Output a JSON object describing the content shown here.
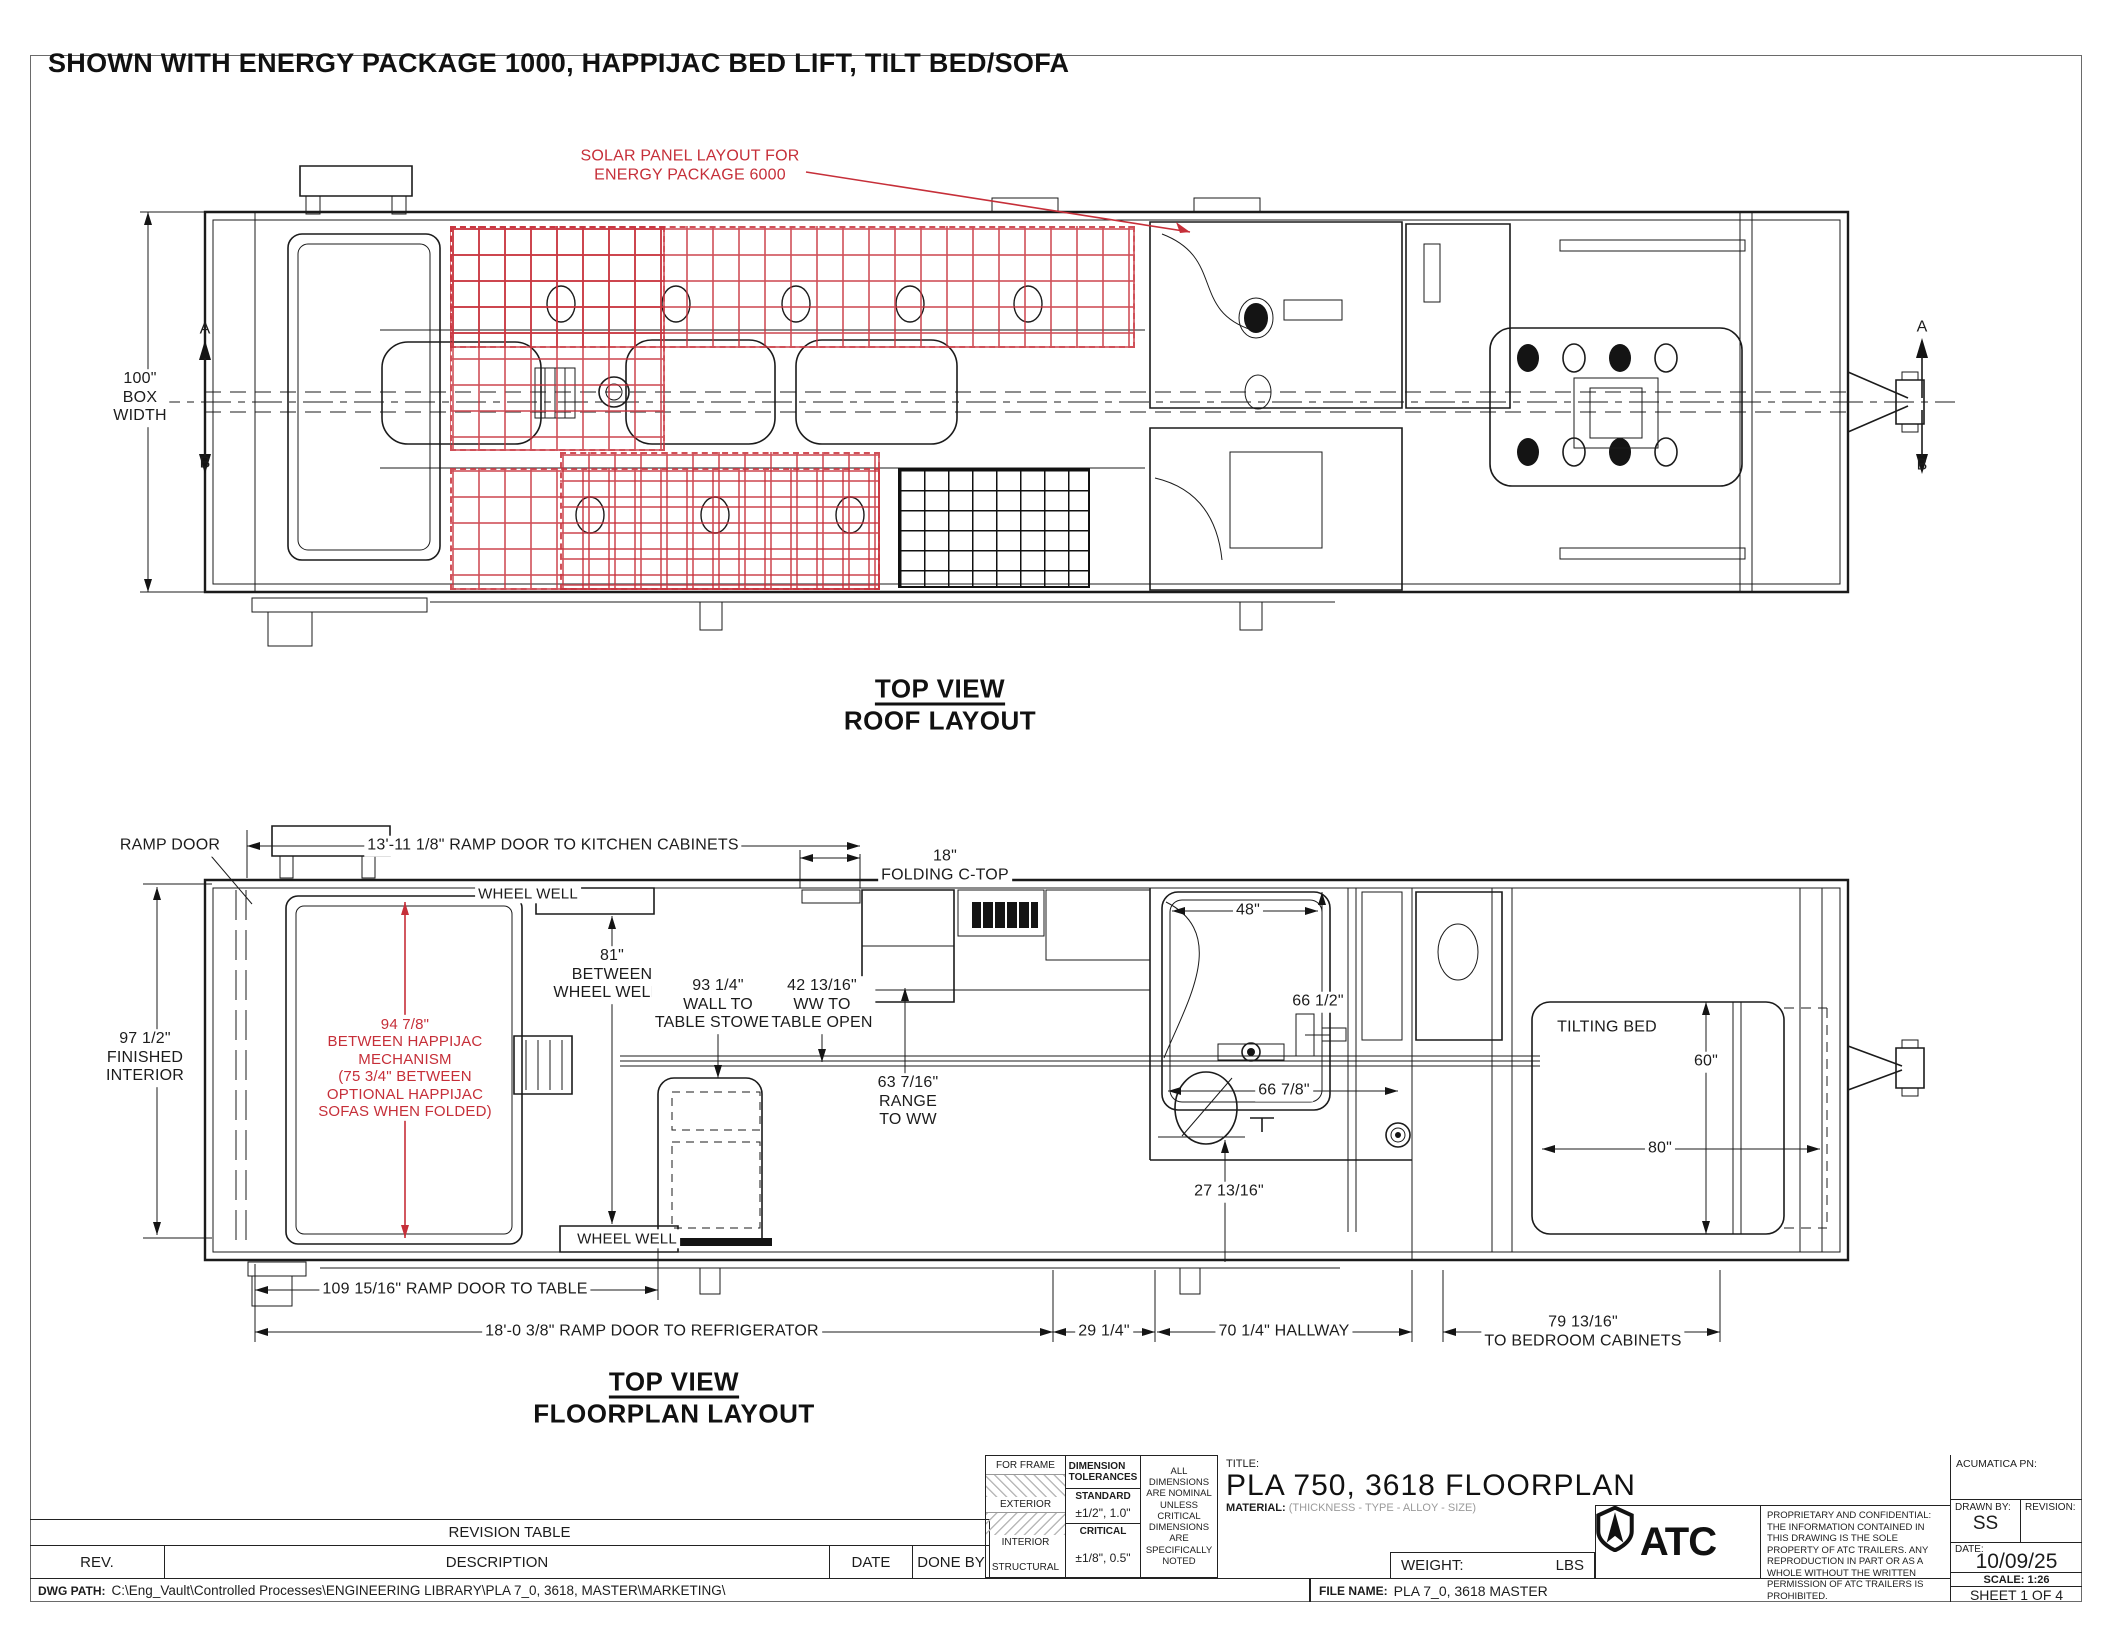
{
  "sheet": {
    "heading": "SHOWN WITH ENERGY PACKAGE 1000, HAPPIJAC BED LIFT, TILT BED/SOFA",
    "accent_red": "#c62f39"
  },
  "roof": {
    "solar_note": "SOLAR PANEL LAYOUT FOR\nENERGY PACKAGE 6000",
    "box_width": "100\"\nBOX\nWIDTH",
    "section_a": "A",
    "section_b": "B",
    "caption": "TOP VIEW",
    "caption_sub": "ROOF LAYOUT"
  },
  "floor": {
    "ramp_door": "RAMP DOOR",
    "dim_kitchen": "13'-11 1/8\" RAMP DOOR TO KITCHEN CABINETS",
    "dim_ctop": "18\"\nFOLDING C-TOP",
    "wheel_well": "WHEEL WELL",
    "wheel_well2": "WHEEL WELL",
    "dim_interior": "97 1/2\"\nFINISHED\nINTERIOR",
    "happijac_note": "94 7/8\"\nBETWEEN HAPPIJAC\nMECHANISM\n(75 3/4\" BETWEEN\nOPTIONAL HAPPIJAC\nSOFAS WHEN FOLDED)",
    "dim_wheelwells": "81\"\nBETWEEN\nWHEEL WELLS",
    "dim_table_stowed": "93 1/4\"\nWALL TO\nTABLE STOWED",
    "dim_table_open": "42 13/16\"\nWW TO\nTABLE OPEN",
    "dim_range": "63 7/16\"\nRANGE\nTO WW",
    "dim_shower": "48\"",
    "dim_shower_wall": "66 1/2\"",
    "dim_bath": "66 7/8\"",
    "dim_27": "27 13/16\"",
    "tilting_bed": "TILTING BED",
    "dim_60": "60\"",
    "dim_80": "80\"",
    "dim_table": "109 15/16\" RAMP DOOR TO TABLE",
    "dim_fridge": "18'-0 3/8\" RAMP DOOR TO REFRIGERATOR",
    "dim_29": "29 1/4\"",
    "dim_hallway": "70 1/4\" HALLWAY",
    "dim_bedroom": "79 13/16\"\nTO BEDROOM CABINETS",
    "caption": "TOP VIEW",
    "caption_sub": "FLOORPLAN LAYOUT"
  },
  "title_block": {
    "revision_table": "REVISION TABLE",
    "col_rev": "REV.",
    "col_description": "DESCRIPTION",
    "col_date": "DATE",
    "col_done_by": "DONE BY",
    "dwg_path_label": "DWG PATH:",
    "dwg_path": "C:\\Eng_Vault\\Controlled Processes\\ENGINEERING LIBRARY\\PLA 7_0, 3618, MASTER\\MARKETING\\",
    "for_frame": "FOR FRAME",
    "exterior": "EXTERIOR",
    "interior": "INTERIOR",
    "structural": "STRUCTURAL",
    "dim_tol": "DIMENSION\nTOLERANCES",
    "standard": "STANDARD",
    "standard_val": "±1/2\", 1.0\"",
    "critical": "CRITICAL",
    "critical_val": "±1/8\", 0.5\"",
    "note": "ALL\nDIMENSIONS\nARE NOMINAL\nUNLESS CRITICAL\nDIMENSIONS\nARE\nSPECIFICALLY\nNOTED",
    "title_label": "TITLE:",
    "title": "PLA 750, 3618 FLOORPLAN",
    "material_label": "MATERIAL:",
    "material_value": "(THICKNESS - TYPE - ALLOY - SIZE)",
    "weight_label": "WEIGHT:",
    "weight_unit": "LBS",
    "file_label": "FILE NAME:",
    "file_name": "PLA 7_0, 3618 MASTER",
    "logo": "ATC",
    "proprietary": "PROPRIETARY AND CONFIDENTIAL: THE INFORMATION CONTAINED IN THIS DRAWING IS THE SOLE PROPERTY OF ATC TRAILERS. ANY REPRODUCTION IN PART OR AS A WHOLE WITHOUT THE WRITTEN PERMISSION OF ATC TRAILERS IS PROHIBITED.",
    "acumatica": "ACUMATICA PN:",
    "drawn_by_label": "DRAWN BY:",
    "drawn_by": "SS",
    "revision_label": "REVISION:",
    "date_label": "DATE:",
    "date": "10/09/25",
    "scale": "SCALE: 1:26",
    "sheet_no": "SHEET 1 OF 4"
  }
}
